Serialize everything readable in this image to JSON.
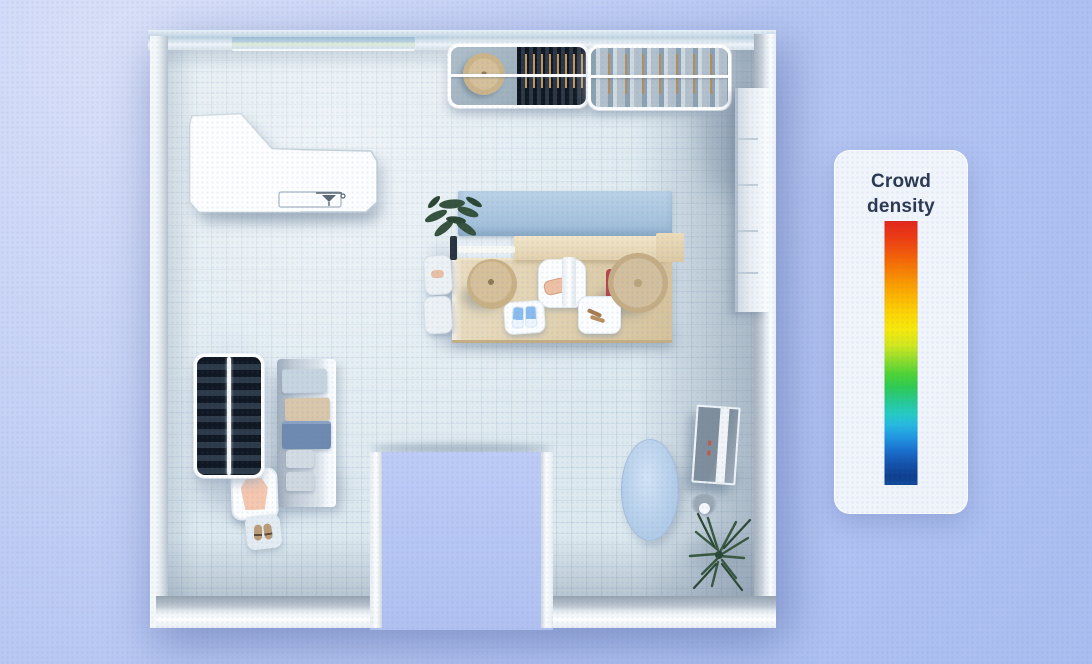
{
  "legend": {
    "title": "Crowd density",
    "gradient_stops": [
      {
        "pos": 0,
        "color": "#e3261c"
      },
      {
        "pos": 6,
        "color": "#ec3a12"
      },
      {
        "pos": 13,
        "color": "#f35d08"
      },
      {
        "pos": 21,
        "color": "#f98b02"
      },
      {
        "pos": 28,
        "color": "#fcb201"
      },
      {
        "pos": 35,
        "color": "#fdd404"
      },
      {
        "pos": 41,
        "color": "#f7e90b"
      },
      {
        "pos": 47,
        "color": "#d2e81e"
      },
      {
        "pos": 52,
        "color": "#97de2b"
      },
      {
        "pos": 58,
        "color": "#4ed335"
      },
      {
        "pos": 63,
        "color": "#2ecb55"
      },
      {
        "pos": 68,
        "color": "#27ca8e"
      },
      {
        "pos": 73,
        "color": "#25cbc2"
      },
      {
        "pos": 77,
        "color": "#26bbe0"
      },
      {
        "pos": 82,
        "color": "#2096e2"
      },
      {
        "pos": 87,
        "color": "#1a6fcd"
      },
      {
        "pos": 92,
        "color": "#1452ab"
      },
      {
        "pos": 97,
        "color": "#0e3e8d"
      },
      {
        "pos": 100,
        "color": "#114d9c"
      }
    ]
  },
  "colors": {
    "bg-top": "#d9e0f8",
    "bg-bottom": "#a9bdf0",
    "floor": "#dde9ef",
    "legend-title": "#2b3a52"
  },
  "scene": {
    "furniture": [
      "reception-counter",
      "tap-icon",
      "wall-vent",
      "hanging-rack-top-left",
      "round-hat-table",
      "hanging-rack-top-right",
      "wall-shelf",
      "display-backdrop-panel",
      "display-table",
      "display-crossbar",
      "potted-plant",
      "hat-display-left",
      "hat-display-right",
      "red-display-stand",
      "pedestal-clothing",
      "pedestal-shoes",
      "pedestal-accessories",
      "hanging-rack-bottom-left",
      "folded-clothes-shelf",
      "shirt-display",
      "shoe-stand",
      "rug",
      "leaning-mirror",
      "floor-plant",
      "entrance-opening"
    ]
  }
}
